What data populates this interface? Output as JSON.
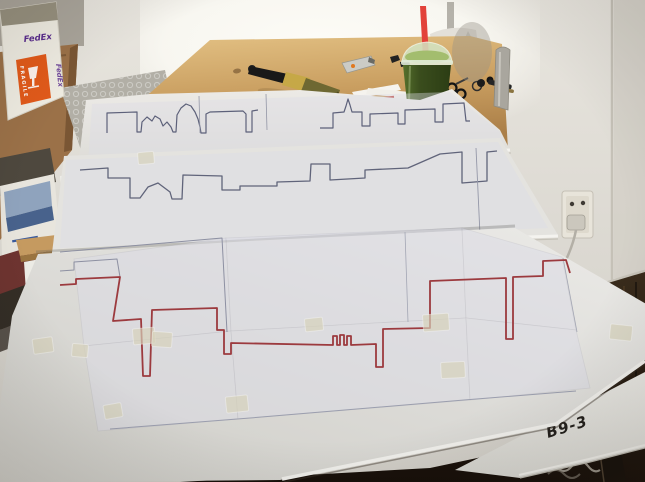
{
  "labels": {
    "board_code": "B9-3",
    "fedex_brand": "FedEx",
    "fragile": "FRAGILE"
  },
  "palette": {
    "wall": "#ddd9d2",
    "window_glare": "#fbfaf4",
    "table_wood": "#c99e60",
    "board_surface": "#e2e1dd",
    "paper_sheet": "#dcdce6",
    "pencil_line": "#60647a",
    "red_pen_line": "#9c3a3e",
    "masking_tape": "#d6d1b9",
    "floor_dark": "#241a10",
    "smoothie_green": "#3a4d1d",
    "straw_red": "#e2423a",
    "fedex_orange": "#e25a1a",
    "fedex_purple": "#5b2d8e",
    "cardboard": "#9b7148"
  },
  "objects": [
    "foam-boards-with-skyline-tracings",
    "paintbrush",
    "utility-knife",
    "binder-clips",
    "paper-scraps",
    "red-pencil",
    "green-smoothie-cup",
    "keys",
    "upright-stapler",
    "scissors",
    "white-chair",
    "fedex-box",
    "cardboard-box",
    "bubble-wrap",
    "book-stack",
    "wall-outlet-with-plug",
    "masking-tape-pieces",
    "table-leg",
    "cable-coil"
  ],
  "drawings": {
    "polylines": [
      {
        "group": "skyline-back",
        "name": "back-skyline-left",
        "stroke": "#5d617a",
        "width": 1.2,
        "points": [
          [
            107,
            133
          ],
          [
            107,
            113
          ],
          [
            137,
            112
          ],
          [
            137,
            132
          ],
          [
            141,
            132
          ],
          [
            142,
            122
          ],
          [
            147,
            117
          ],
          [
            152,
            121
          ],
          [
            155,
            116
          ],
          [
            160,
            119
          ],
          [
            163,
            126
          ],
          [
            167,
            122
          ],
          [
            171,
            127
          ],
          [
            173,
            132
          ],
          [
            176,
            132
          ],
          [
            177,
            115
          ],
          [
            181,
            108
          ],
          [
            186,
            104
          ],
          [
            191,
            106
          ],
          [
            195,
            112
          ],
          [
            198,
            119
          ],
          [
            200,
            127
          ],
          [
            201,
            133
          ],
          [
            206,
            133
          ],
          [
            206,
            114
          ],
          [
            210,
            112
          ],
          [
            243,
            111
          ],
          [
            246,
            114
          ],
          [
            246,
            132
          ],
          [
            252,
            132
          ],
          [
            252,
            111
          ],
          [
            258,
            110
          ]
        ]
      },
      {
        "group": "skyline-back",
        "name": "back-skyline-right",
        "stroke": "#5d617a",
        "width": 1.2,
        "points": [
          [
            320,
            128
          ],
          [
            333,
            128
          ],
          [
            333,
            113
          ],
          [
            344,
            112
          ],
          [
            346,
            106
          ],
          [
            348,
            99
          ],
          [
            350,
            105
          ],
          [
            352,
            112
          ],
          [
            362,
            112
          ],
          [
            362,
            126
          ],
          [
            370,
            126
          ],
          [
            370,
            114
          ],
          [
            398,
            113
          ],
          [
            398,
            124
          ],
          [
            405,
            124
          ],
          [
            405,
            110
          ],
          [
            435,
            109
          ],
          [
            435,
            122
          ],
          [
            443,
            122
          ],
          [
            443,
            104
          ],
          [
            464,
            103
          ],
          [
            466,
            121
          ],
          [
            470,
            121
          ]
        ]
      },
      {
        "group": "skyline-back",
        "name": "back-sheet-joint-1",
        "stroke": "#9396a6",
        "width": 0.8,
        "points": [
          [
            199,
            96
          ],
          [
            200,
            133
          ]
        ]
      },
      {
        "group": "skyline-back",
        "name": "back-sheet-joint-2",
        "stroke": "#9396a6",
        "width": 0.8,
        "points": [
          [
            266,
            94
          ],
          [
            267,
            130
          ]
        ]
      },
      {
        "group": "skyline-middle",
        "name": "middle-skyline",
        "stroke": "#60647a",
        "width": 1.3,
        "points": [
          [
            80,
            170
          ],
          [
            108,
            168
          ],
          [
            108,
            178
          ],
          [
            130,
            178
          ],
          [
            130,
            198
          ],
          [
            140,
            198
          ],
          [
            148,
            187
          ],
          [
            158,
            183
          ],
          [
            170,
            192
          ],
          [
            172,
            199
          ],
          [
            182,
            199
          ],
          [
            183,
            175
          ],
          [
            222,
            176
          ],
          [
            222,
            190
          ],
          [
            240,
            190
          ],
          [
            240,
            186
          ],
          [
            277,
            186
          ],
          [
            277,
            182
          ],
          [
            310,
            181
          ],
          [
            311,
            164
          ],
          [
            330,
            164
          ],
          [
            330,
            180
          ],
          [
            365,
            178
          ],
          [
            365,
            170
          ],
          [
            408,
            168
          ],
          [
            440,
            154
          ],
          [
            462,
            152
          ],
          [
            462,
            183
          ],
          [
            487,
            181
          ],
          [
            487,
            152
          ],
          [
            497,
            151
          ]
        ]
      },
      {
        "group": "skyline-middle",
        "name": "middle-sheet-joint",
        "stroke": "#9497a8",
        "width": 0.9,
        "points": [
          [
            476,
            148
          ],
          [
            480,
            235
          ]
        ]
      },
      {
        "group": "front-pencil",
        "name": "front-pencil-outline-top",
        "stroke": "#8d90a2",
        "width": 1,
        "points": [
          [
            60,
            252
          ],
          [
            222,
            238
          ],
          [
            227,
            332
          ]
        ]
      },
      {
        "group": "front-pencil",
        "name": "front-pencil-step",
        "stroke": "#8d90a2",
        "width": 1,
        "points": [
          [
            60,
            271
          ],
          [
            74,
            270
          ],
          [
            74,
            262
          ],
          [
            117,
            259
          ],
          [
            120,
            277
          ]
        ]
      },
      {
        "group": "front-pencil",
        "name": "front-pencil-baseline",
        "stroke": "#9b9eae",
        "width": 1,
        "points": [
          [
            110,
            429
          ],
          [
            250,
            418
          ],
          [
            464,
            400
          ],
          [
            576,
            391
          ]
        ]
      },
      {
        "group": "front-pencil",
        "name": "front-sheet-joint-1",
        "stroke": "#a3a6b4",
        "width": 0.8,
        "points": [
          [
            405,
            232
          ],
          [
            408,
            322
          ]
        ]
      },
      {
        "group": "front-pencil",
        "name": "front-sheet-joint-2",
        "stroke": "#a3a6b4",
        "width": 0.8,
        "points": [
          [
            563,
            258
          ],
          [
            577,
            332
          ]
        ]
      },
      {
        "group": "front-red",
        "name": "red-traced-skyline",
        "stroke": "#9c3a3e",
        "width": 1.8,
        "points": [
          [
            60,
            285
          ],
          [
            76,
            284
          ],
          [
            76,
            279
          ],
          [
            120,
            277
          ],
          [
            113,
            321
          ],
          [
            141,
            319
          ],
          [
            143,
            376
          ],
          [
            150,
            376
          ],
          [
            152,
            310
          ],
          [
            217,
            308
          ],
          [
            217,
            330
          ],
          [
            224,
            330
          ],
          [
            224,
            354
          ],
          [
            231,
            354
          ],
          [
            231,
            343
          ],
          [
            333,
            345
          ],
          [
            333,
            336
          ],
          [
            337,
            336
          ],
          [
            337,
            345
          ],
          [
            340,
            345
          ],
          [
            340,
            335
          ],
          [
            344,
            335
          ],
          [
            344,
            345
          ],
          [
            347,
            345
          ],
          [
            347,
            336
          ],
          [
            351,
            336
          ],
          [
            351,
            345
          ],
          [
            376,
            344
          ],
          [
            376,
            367
          ],
          [
            383,
            367
          ],
          [
            383,
            329
          ],
          [
            430,
            328
          ],
          [
            430,
            281
          ],
          [
            506,
            278
          ],
          [
            506,
            339
          ],
          [
            513,
            339
          ],
          [
            513,
            277
          ],
          [
            543,
            276
          ],
          [
            543,
            261
          ],
          [
            566,
            260
          ],
          [
            570,
            273
          ]
        ]
      }
    ],
    "tape_pieces": [
      [
        33,
        338,
        20,
        15,
        -8
      ],
      [
        133,
        328,
        22,
        16,
        -5
      ],
      [
        152,
        332,
        20,
        15,
        4
      ],
      [
        226,
        396,
        22,
        16,
        -6
      ],
      [
        104,
        404,
        18,
        14,
        -10
      ],
      [
        423,
        314,
        26,
        17,
        -4
      ],
      [
        610,
        325,
        22,
        15,
        6
      ],
      [
        441,
        362,
        24,
        16,
        -3
      ],
      [
        305,
        318,
        18,
        13,
        -6
      ],
      [
        72,
        344,
        16,
        13,
        5
      ],
      [
        138,
        152,
        16,
        12,
        -5
      ]
    ]
  }
}
